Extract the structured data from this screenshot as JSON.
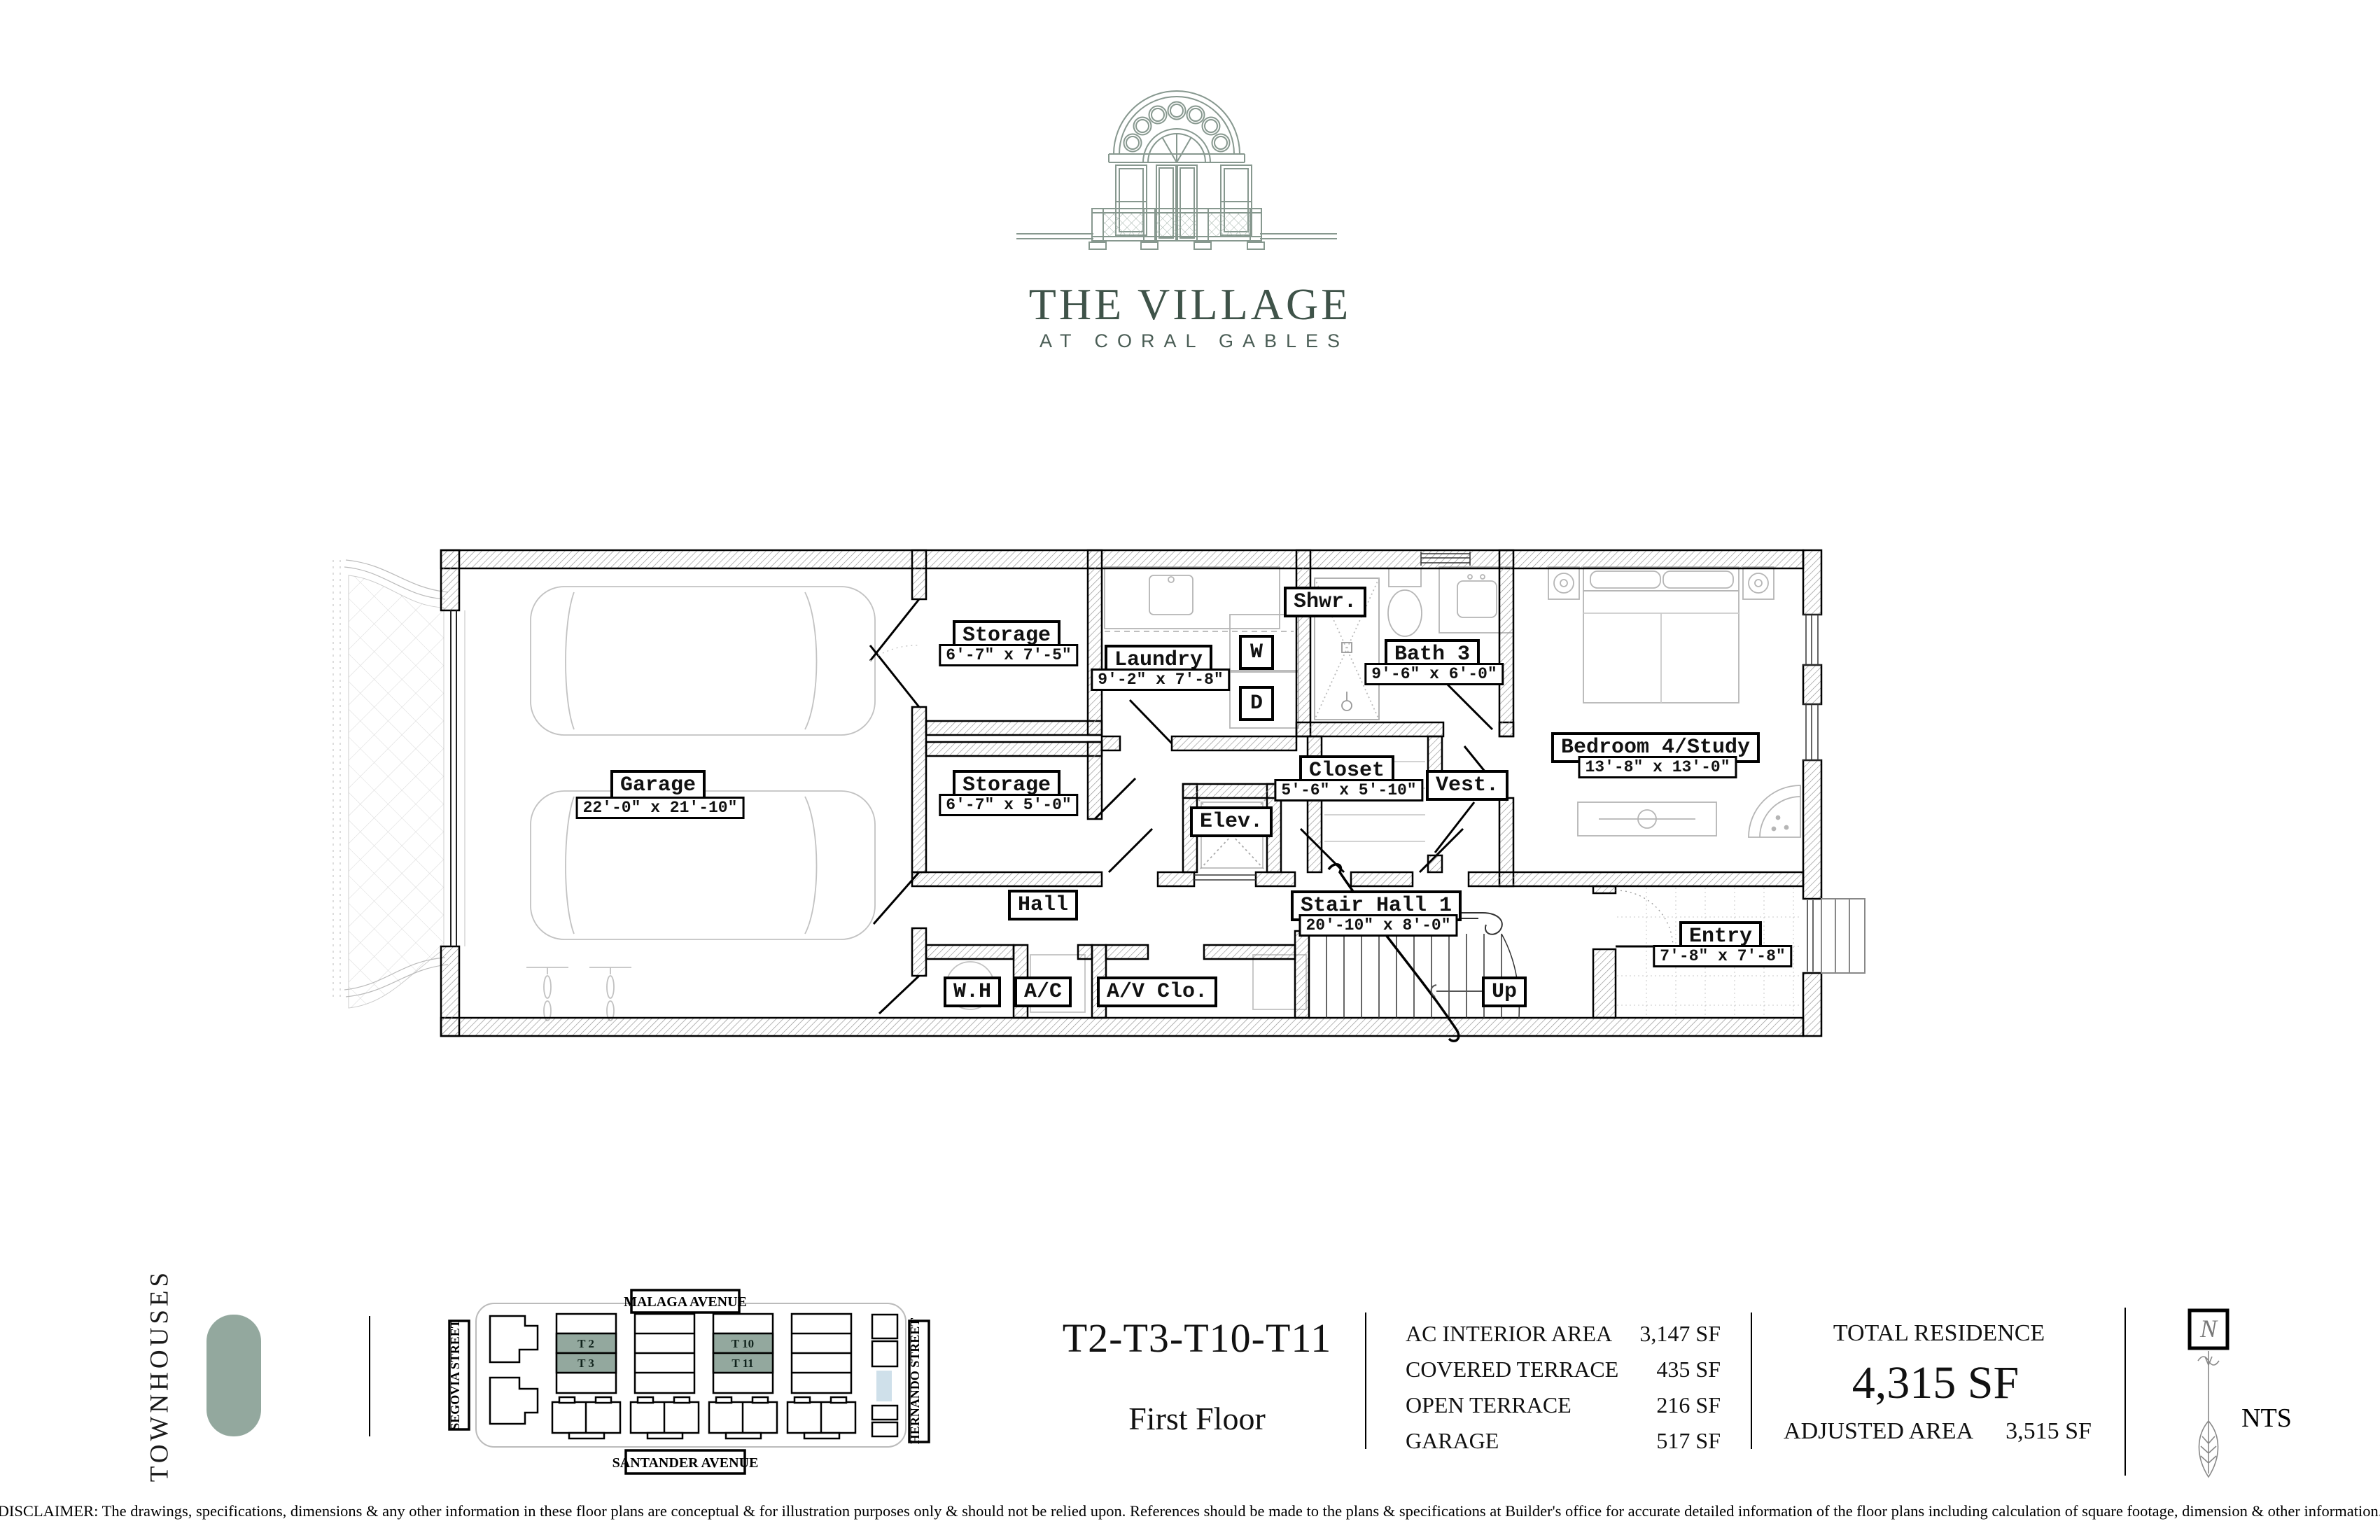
{
  "brand": {
    "name": "THE VILLAGE",
    "subname": "AT CORAL GABLES",
    "accent_color": "#3f5349",
    "sage_color": "#93a89e"
  },
  "plan": {
    "rooms": [
      {
        "name": "Garage",
        "dim": "22'-0\" x 21'-10\""
      },
      {
        "name": "Storage",
        "dim": "6'-7\" x 7'-5\""
      },
      {
        "name": "Laundry",
        "dim": "9'-2\" x 7'-8\""
      },
      {
        "name": "Shwr."
      },
      {
        "name": "Bath 3",
        "dim": "9'-6\" x 6'-0\""
      },
      {
        "name": "Storage",
        "dim": "6'-7\" x 5'-0\""
      },
      {
        "name": "Elev."
      },
      {
        "name": "Closet",
        "dim": "5'-6\" x 5'-10\""
      },
      {
        "name": "Vest."
      },
      {
        "name": "Bedroom 4/Study",
        "dim": "13'-8\" x 13'-0\""
      },
      {
        "name": "Hall"
      },
      {
        "name": "Stair Hall 1",
        "dim": "20'-10\" x 8'-0\""
      },
      {
        "name": "W.H"
      },
      {
        "name": "A/C"
      },
      {
        "name": "A/V Clo."
      },
      {
        "name": "Up"
      },
      {
        "name": "Entry",
        "dim": "7'-8\" x 7'-8\""
      }
    ],
    "appliances": {
      "washer": "W",
      "dryer": "D"
    }
  },
  "sitemap": {
    "section_label": "TOWNHOUSES",
    "streets": {
      "top": "MALAGA  AVENUE",
      "bottom": "SANTANDER  AVENUE",
      "left": "SEGOVIA  STREET",
      "right": "HERNANDO  STREET"
    },
    "units": {
      "t2": "T 2",
      "t3": "T 3",
      "t10": "T 10",
      "t11": "T 11"
    },
    "highlight_color": "#93a89e",
    "pool_color": "#cfe0ea"
  },
  "title": {
    "units": "T2-T3-T10-T11",
    "floor": "First Floor"
  },
  "areas": {
    "rows": [
      {
        "label": "AC INTERIOR AREA",
        "value": "3,147 SF"
      },
      {
        "label": "COVERED TERRACE",
        "value": "435 SF"
      },
      {
        "label": "OPEN TERRACE",
        "value": "216 SF"
      },
      {
        "label": "GARAGE",
        "value": "517 SF"
      }
    ],
    "total_label": "TOTAL RESIDENCE",
    "total_value": "4,315 SF",
    "adjusted_label": "ADJUSTED AREA",
    "adjusted_value": "3,515 SF"
  },
  "compass": {
    "north": "N",
    "scale": "NTS"
  },
  "disclaimer": "DISCLAIMER: The drawings, specifications, dimensions & any other information in these floor plans are conceptual & for illustration purposes only & should not be relied upon. References should be made to the plans & specifications at Builder's office for accurate detailed information of the floor plans including calculation of square footage, dimension & other information."
}
